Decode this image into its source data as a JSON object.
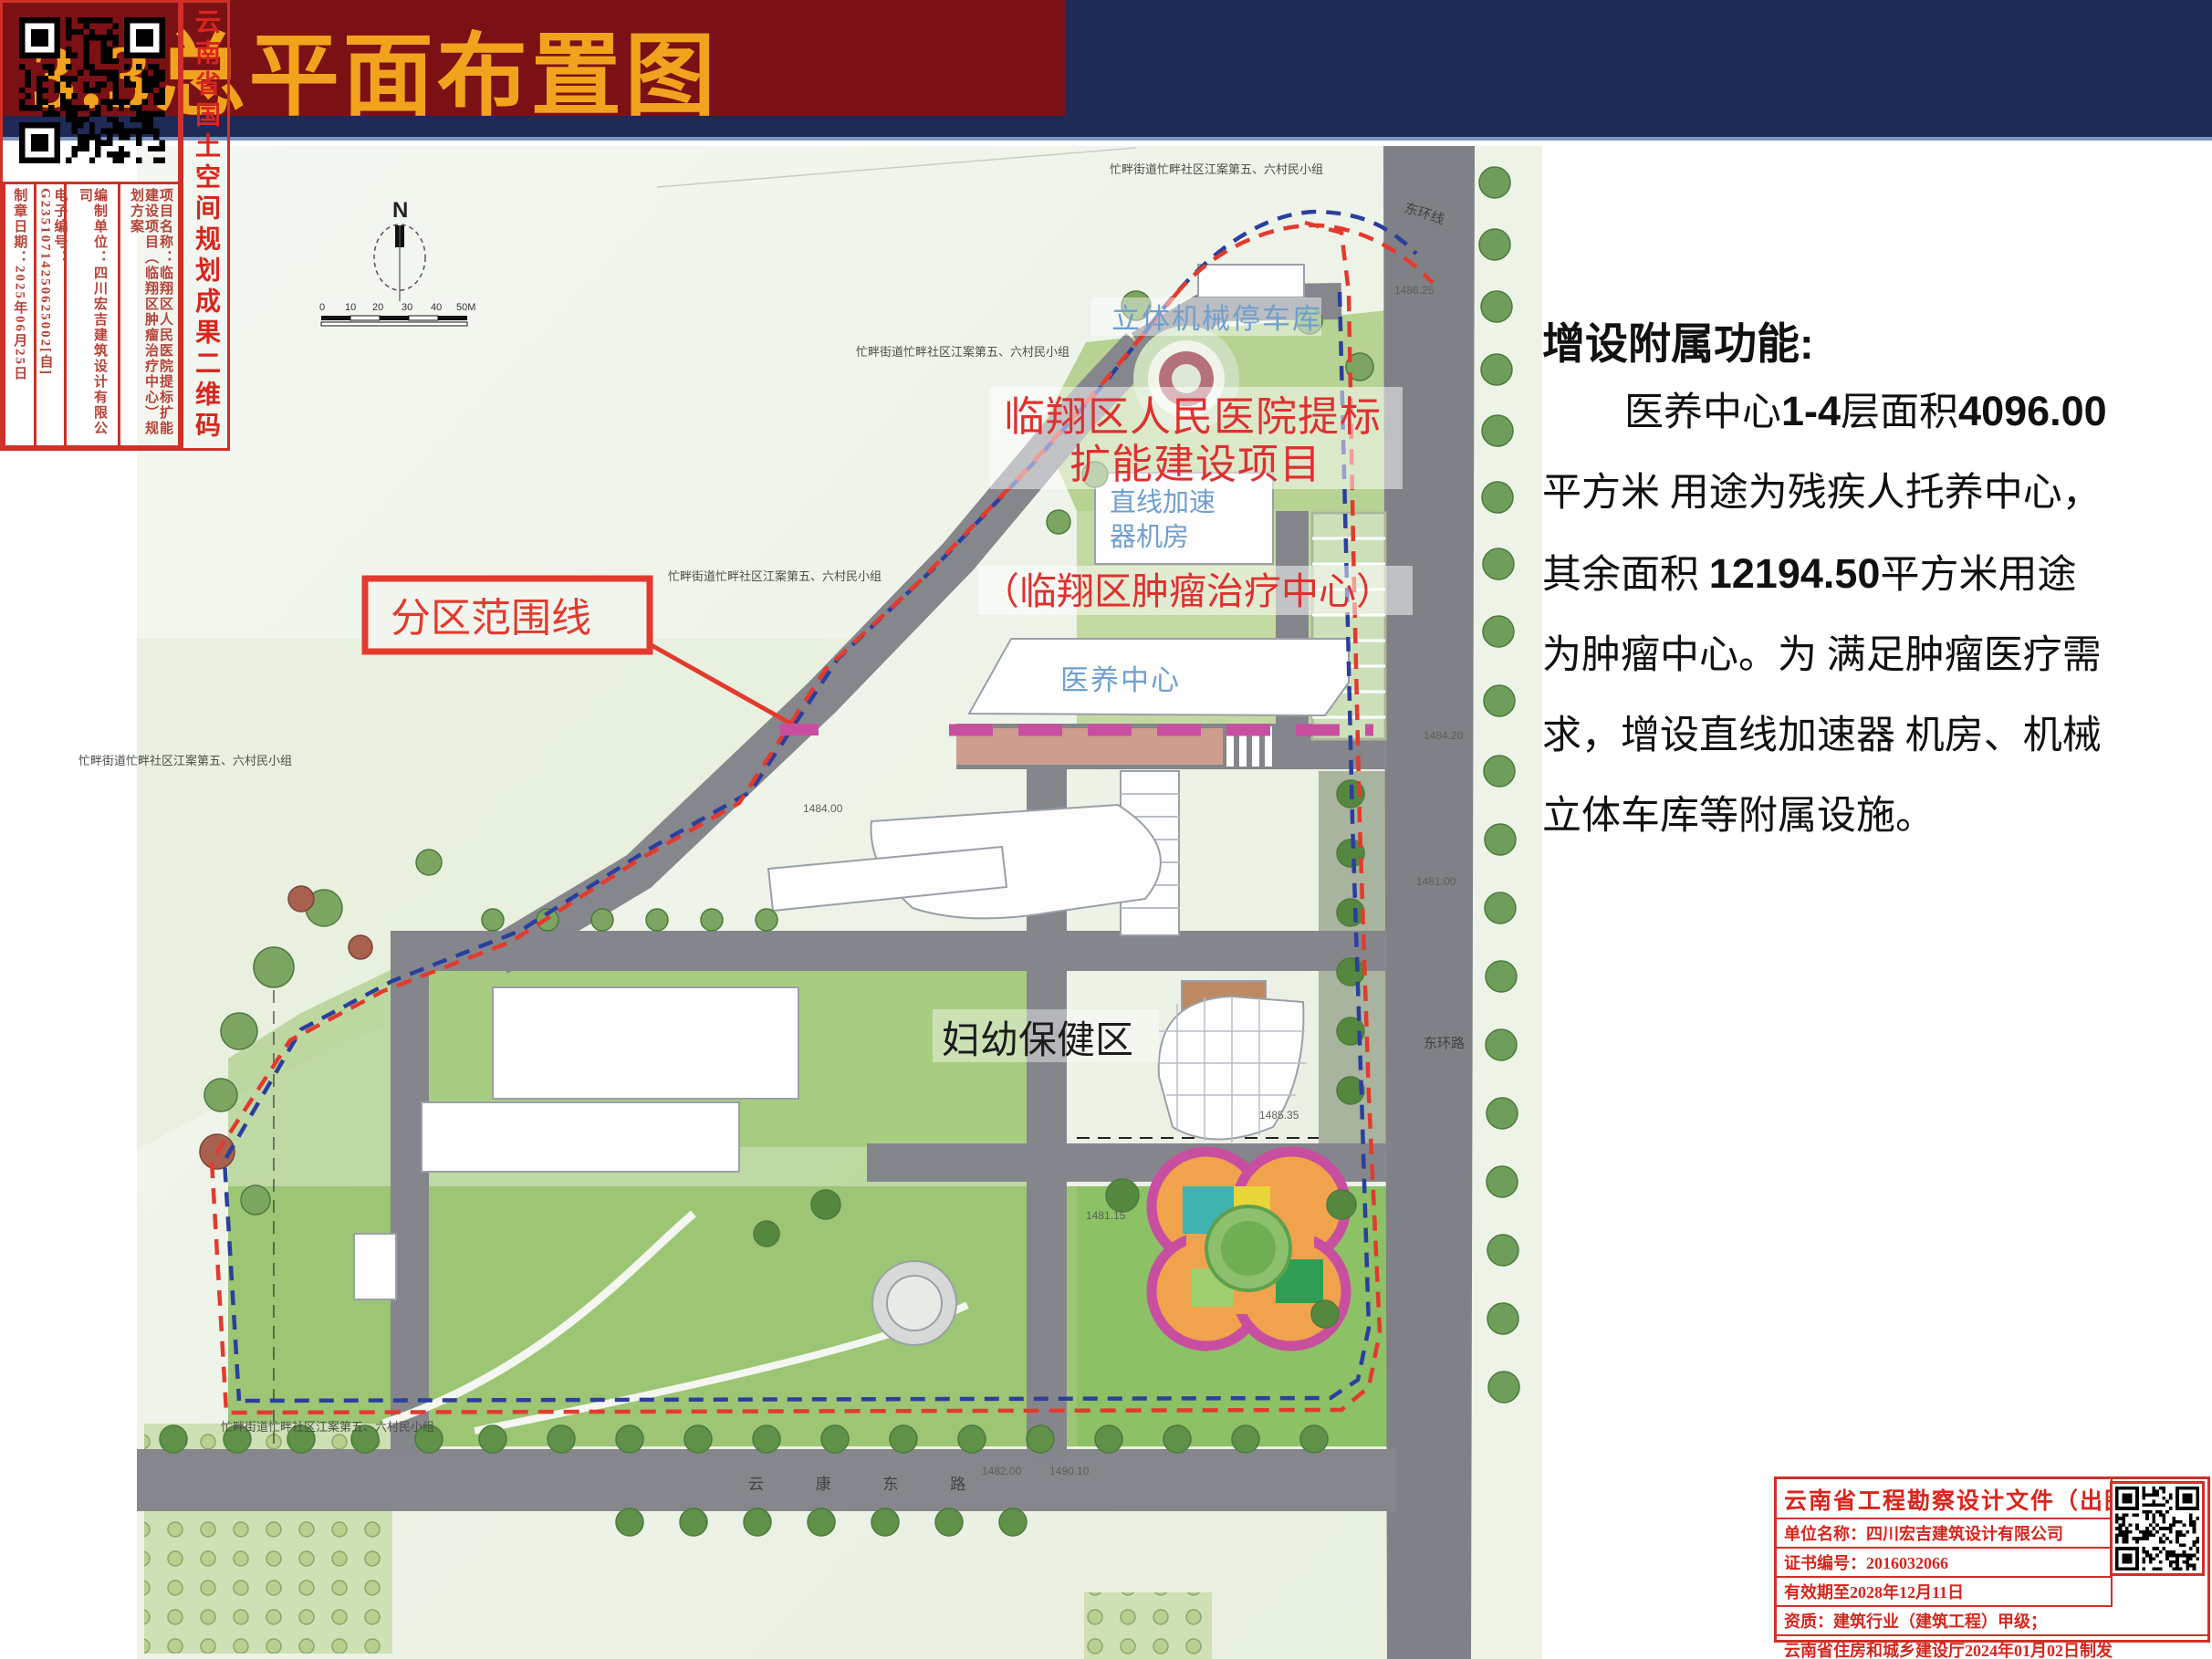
{
  "header": {
    "title": "3.3总平面布置图"
  },
  "description": {
    "heading": "增设附属功能:",
    "line1_pre": "医养中心",
    "line1_num1": "1-4",
    "line1_mid": "层面积",
    "line1_num2": "4096.00",
    "line2": "平方米 用途为残疾人托养中心，",
    "line3_pre": "其余面积 ",
    "line3_num": "12194.50",
    "line3_post": "平方米用途",
    "line4": "为肿瘤中心。为 满足肿瘤医疗需",
    "line5": "求，增设直线加速器 机房、机械",
    "line6": "立体车库等附属设施。"
  },
  "map": {
    "compass": "N",
    "scale_ticks": [
      "0",
      "10",
      "20",
      "30",
      "40",
      "50M"
    ],
    "village_label": "忙畔街道忙畔社区江案第五、六村民小组",
    "road_east_ring_top": "东环线",
    "road_east_ring_bottom": "东环路",
    "road_bottom": "云 康 东 路",
    "parking_garage": "立体机械停车库",
    "project_line1": "临翔区人民医院提标",
    "project_line2": "扩能建设项目",
    "linac_line1": "直线加速",
    "linac_line2": "器机房",
    "oncology": "（临翔区肿瘤治疗中心）",
    "partition": "分区范围线",
    "elder_center": "医养中心",
    "maternal_zone": "妇幼保健区",
    "elevations": {
      "e1": "1486.25",
      "e2": "1484.20",
      "e3": "1481.00",
      "e4": "1484.00",
      "e5": "1482.00",
      "e6": "1490.10",
      "e7": "1485.35",
      "e8": "1481.15"
    }
  },
  "planning_cert": {
    "title": "云南省国土空间规划成果二维码",
    "project_name": "项目名称：临翔区人民医院提标扩能建设项目（临翔区肿瘤治疗中心）规划方案",
    "design_unit": "编制单位：四川宏吉建筑设计有限公司",
    "electronic_no": "电子编号：G23510714250625002[自]",
    "seal_date": "制章日期：2025年06月25日"
  },
  "drawing_stamp": {
    "title": "云南省工程勘察设计文件（出图）专用章",
    "unit": "单位名称：四川宏吉建筑设计有限公司",
    "cert_no": "证书编号：2016032066",
    "valid": "有效期至2028年12月11日",
    "qualification": "资质：建筑行业（建筑工程）甲级；",
    "issued": "云南省住房和城乡建设厅2024年01月02日制发",
    "project_line": "项目出图章编号：22202506270011 项目名称：在临翔区人民医院提标扩能建设项目(临翔区肿瘤治疗中心)规划方案　用途：出图"
  }
}
